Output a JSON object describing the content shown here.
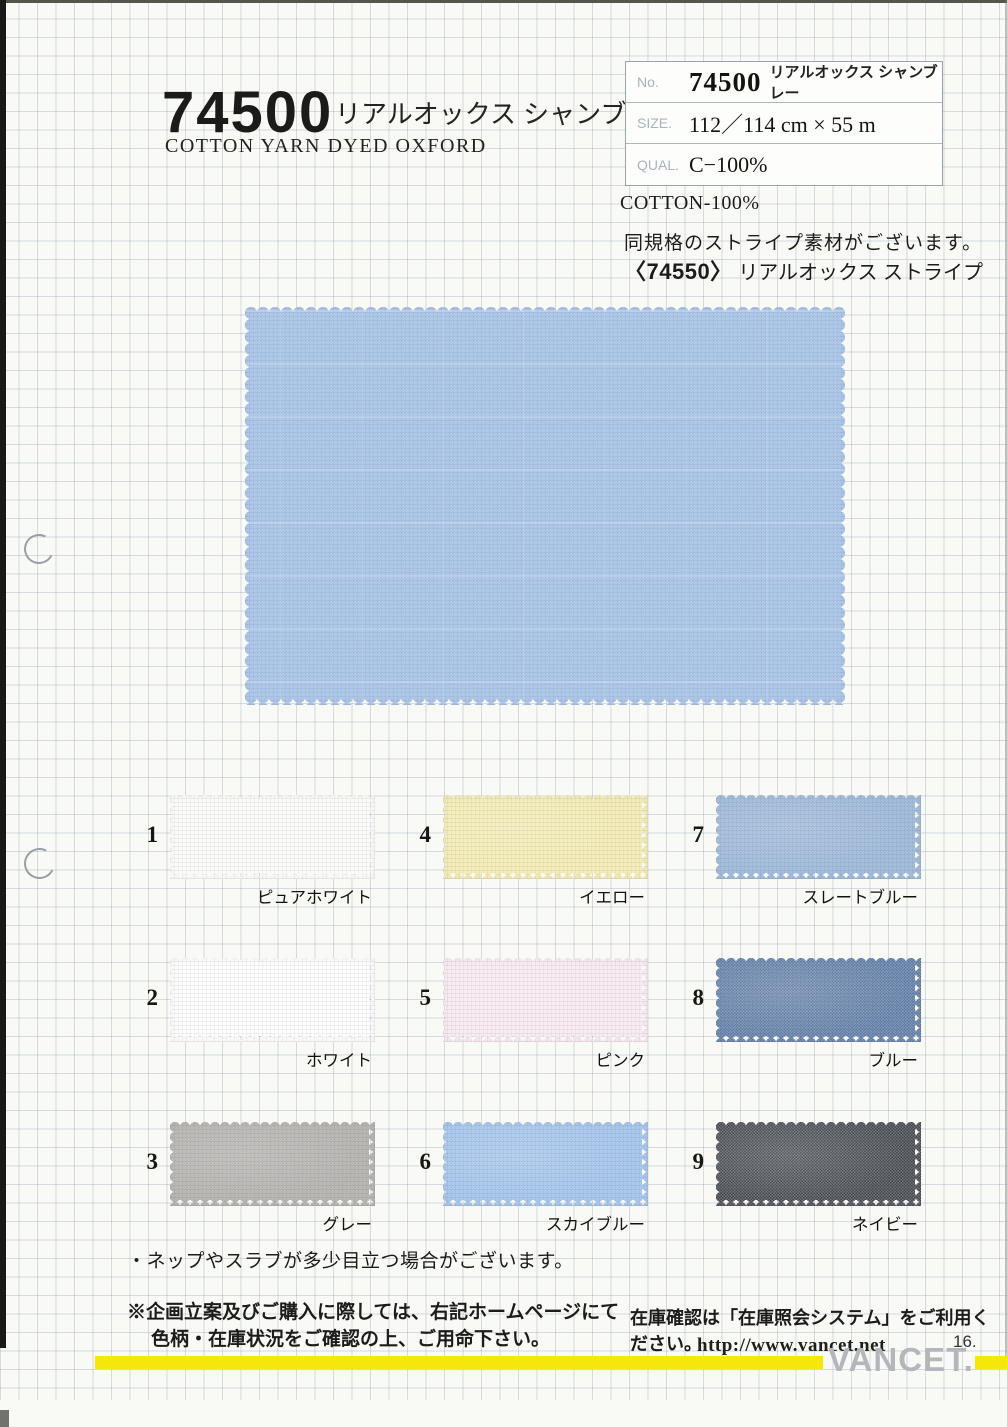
{
  "header": {
    "product_no": "74500",
    "product_name_jp": "リアルオックス シャンブレー",
    "product_name_en": "COTTON YARN DYED OXFORD"
  },
  "spec_box": {
    "rows": [
      {
        "label": "No.",
        "value": "74500",
        "sub": "リアルオックス シャンブレー"
      },
      {
        "label": "SIZE.",
        "value": "112／114 cm × 55 m"
      },
      {
        "label": "QUAL.",
        "value": "C−100%"
      }
    ]
  },
  "composition": "COTTON-100%",
  "stripe_note": {
    "line1": "同規格のストライプ素材がございます。",
    "ref_no": "〈74550〉",
    "ref_name": "リアルオックス ストライプ"
  },
  "main_swatch": {
    "color": "#a7c3e7"
  },
  "swatches": [
    {
      "no": "1",
      "label": "ピュアホワイト",
      "color": "#fcfcfa"
    },
    {
      "no": "2",
      "label": "ホワイト",
      "color": "#fdfdfd"
    },
    {
      "no": "3",
      "label": "グレー",
      "color": "#b2b1ae"
    },
    {
      "no": "4",
      "label": "イエロー",
      "color": "#f3ecb6"
    },
    {
      "no": "5",
      "label": "ピンク",
      "color": "#f8eaf2"
    },
    {
      "no": "6",
      "label": "スカイブルー",
      "color": "#a2c3eb"
    },
    {
      "no": "7",
      "label": "スレートブルー",
      "color": "#9cb7d9"
    },
    {
      "no": "8",
      "label": "ブルー",
      "color": "#5e7ca6"
    },
    {
      "no": "9",
      "label": "ネイビー",
      "color": "#44484f"
    }
  ],
  "footer": {
    "nep_note": "・ネップやスラブが多少目立つ場合がございます。",
    "purchase_note_1": "※企画立案及びご購入に際しては、右記ホームページにて",
    "purchase_note_2": "色柄・在庫状況をご確認の上、ご用命下さい。",
    "stock_note": "在庫確認は「在庫照会システム」をご利用ください。",
    "url": "http://www.vancet.net",
    "page_no": "16.",
    "brand": "VANCET."
  },
  "colors": {
    "accent_yellow": "#f6e70a",
    "brand_gray": "#b3b7bb",
    "paper": "#f9f9f6"
  }
}
